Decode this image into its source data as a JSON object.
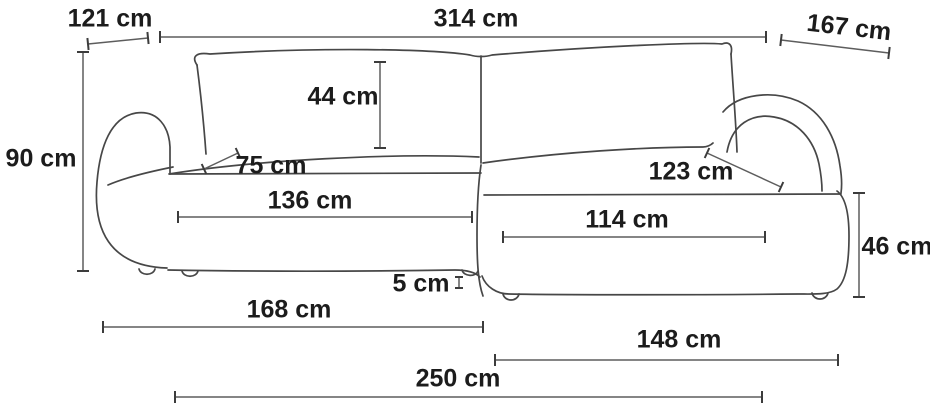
{
  "diagram": {
    "title": "corner-sofa-dimension-drawing",
    "unit": "cm",
    "dimensions": {
      "arm_width_top": {
        "label": "121 cm",
        "value": 121
      },
      "total_width": {
        "label": "314 cm",
        "value": 314
      },
      "chaise_width_top": {
        "label": "167 cm",
        "value": 167
      },
      "total_height": {
        "label": "90 cm",
        "value": 90
      },
      "backrest_cushion_height": {
        "label": "44 cm",
        "value": 44
      },
      "left_seat_depth": {
        "label": "75 cm",
        "value": 75
      },
      "left_seat_width": {
        "label": "136 cm",
        "value": 136
      },
      "right_seat_depth": {
        "label": "123 cm",
        "value": 123
      },
      "right_seat_width": {
        "label": "114 cm",
        "value": 114
      },
      "right_seat_height": {
        "label": "46 cm",
        "value": 46
      },
      "leg_height": {
        "label": "5 cm",
        "value": 5
      },
      "left_base_width": {
        "label": "168 cm",
        "value": 168
      },
      "right_base_width": {
        "label": "148 cm",
        "value": 148
      },
      "total_depth_bottom": {
        "label": "250 cm",
        "value": 250
      }
    },
    "colors": {
      "sofa_line": "#474747",
      "dimension_line": "#5d5d5d",
      "tick": "#3c3c3c",
      "text": "#1c1c1c",
      "background": "#ffffff"
    }
  }
}
